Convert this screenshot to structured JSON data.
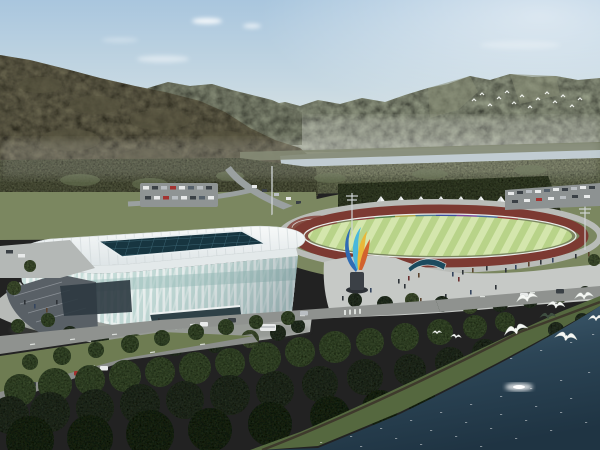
{
  "scene": {
    "description": "Aerial architectural rendering of a riverside sports complex: a white lattice-facade stadium with dark glass skylight roof, an athletics track with striped green infield, a row of white canopy tents over a rainbow-colored banner wall, a blue-and-orange flame sculpture, plazas with pedestrians, tree-lined roads with vehicles, forested mountains, a pale river, dense foreground woods and a dark blue lake with white egrets in flight.",
    "elements": {
      "sky": "hazy blue sky with thin clouds",
      "mountains": "forested mountain ranges on the horizon",
      "hill": "large wooded hill sloping from upper left",
      "river": "pale river band below the far range",
      "stadium": "white arena with vertical-rib glass facade and dark skylight grid",
      "track": "maroon running track with striped green infield",
      "tents": "eight white peaked canopy tents",
      "rainbow_wall": "multicolored banner wall behind the track",
      "sculpture": "flame-shaped sculpture in blue, cyan, yellow and orange",
      "plaza": "light concrete plaza with pedestrians and trees",
      "roads": "tree-lined boulevards with cars and a bus",
      "forest": "dense dark green foreground trees",
      "lake": "dark blue-green water with sun glint",
      "birds": "white egrets flying over shoreline trees and a distant flock near the mountains"
    },
    "bird_count_foreground": 9,
    "bird_count_distant_flock": 14,
    "tent_count": 8
  },
  "palette": {
    "sky_top": "#a9c6de",
    "sky_horizon": "#eceee9",
    "mountain_far": "#99a089",
    "mountain_mid": "#8b927b",
    "hill": "#6e6b53",
    "river": "#b6c4ca",
    "treeband": "#79805f",
    "treeband2": "#6f7758",
    "lawn": "#7b8760",
    "track": "#7c3a32",
    "infield_light": "#d4e6ad",
    "infield_dark": "#b8d389",
    "tent": "#f3f5f5",
    "plaza": "#c6c9c6",
    "roof": "#f0f3f4",
    "fascia": "#e3e9ea",
    "skylight": "#173540",
    "glass": "#c9dfdb",
    "ramp": "#596066",
    "entrance": "#2f4147",
    "road": "#8f928f",
    "parking": "#8f9494",
    "forest": "#2a3625",
    "bank": "#55683f",
    "shore_dirt": "#3e3a2c",
    "water_far": "#47667a",
    "water_near": "#1f3443",
    "bird": "#f5f7f4",
    "bird_shadow": "#3f4f41",
    "sculpture_blue": "#2f6cb4",
    "sculpture_cyan": "#49b8dc",
    "sculpture_yellow": "#e9b83a",
    "sculpture_orange": "#d2622e",
    "pedestal": "#3b4046",
    "canopy_structure": "#1c4a5e",
    "wall_colors": [
      "#8a4242",
      "#4e7d4a",
      "#b3a94e",
      "#4f7d92",
      "#3c4f9e",
      "#7b4a9e",
      "#4a6aa0",
      "#963f3f"
    ]
  }
}
